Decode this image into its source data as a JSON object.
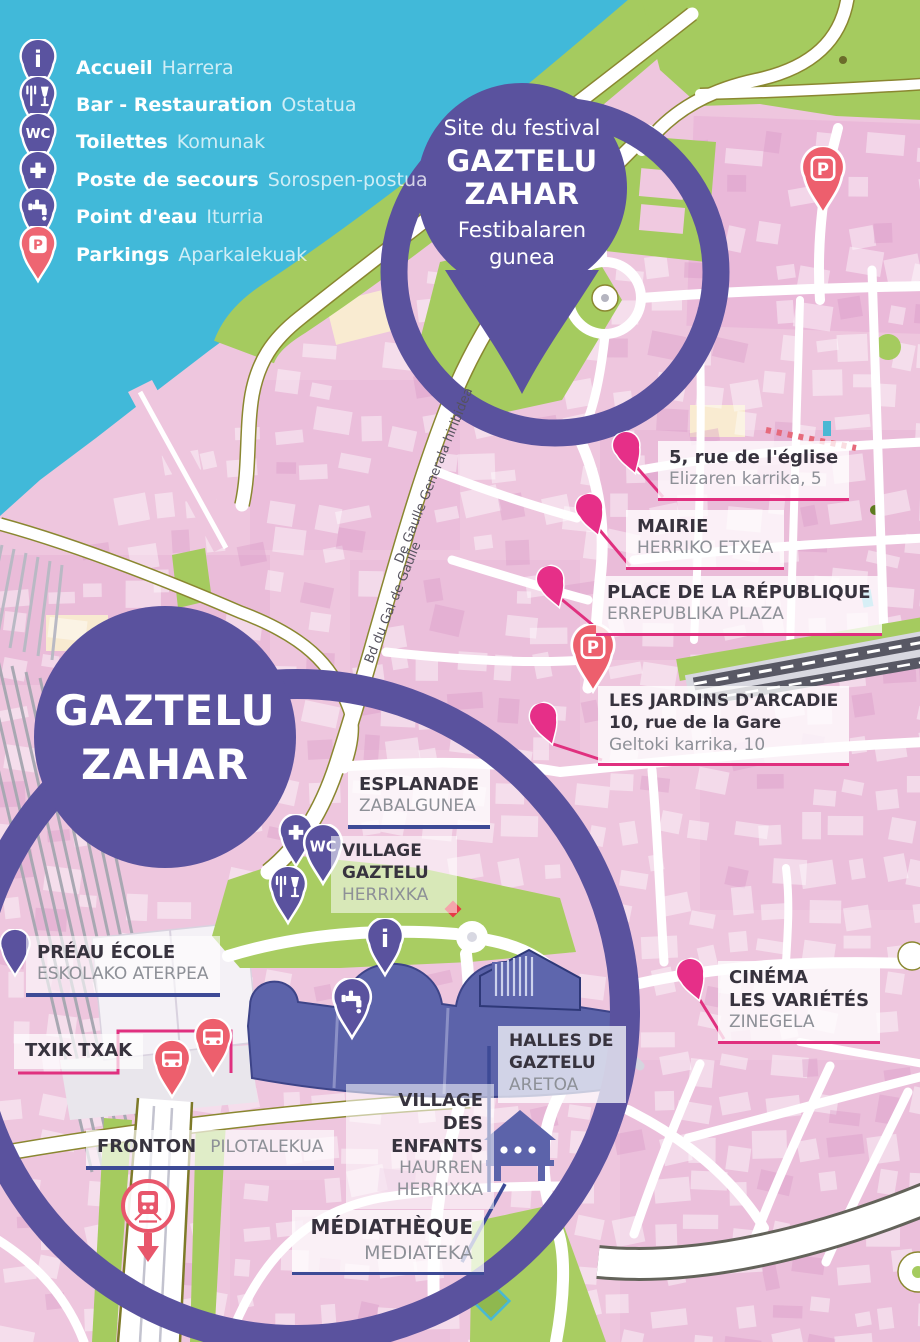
{
  "colors": {
    "water": "#41b9d9",
    "land": "#eec6de",
    "green": "#a5cb5f",
    "purple": "#5a529e",
    "building_purple": "#5c63aa",
    "poi_pink": "#e62f88",
    "coral": "#ed5f6d",
    "label_dark": "#37333e",
    "label_gray": "#8d9097",
    "leader_pink": "#e0307f",
    "connector_blue": "#3d4a96"
  },
  "glyphs": {
    "info": "i",
    "wc": "WC",
    "parking": "P"
  },
  "legend": {
    "accueil": {
      "fr": "Accueil",
      "eu": "Harrera"
    },
    "bar": {
      "fr": "Bar - Restauration",
      "eu": "Ostatua"
    },
    "toilettes": {
      "fr": "Toilettes",
      "eu": "Komunak"
    },
    "secours": {
      "fr": "Poste de secours",
      "eu": "Sorospen-postua"
    },
    "eau": {
      "fr": "Point d'eau",
      "eu": "Iturria"
    },
    "parkings": {
      "fr": "Parkings",
      "eu": "Aparkalekuak"
    }
  },
  "festival_pin": {
    "subtitle": "Site du festival",
    "title1": "GAZTELU",
    "title2": "ZAHAR",
    "eu1": "Festibalaren",
    "eu2": "gunea"
  },
  "site_circle": {
    "line1": "GAZTELU",
    "line2": "ZAHAR"
  },
  "poi": {
    "eglise": {
      "fr": "5, rue de l'église",
      "eu": "Elizaren karrika, 5"
    },
    "mairie": {
      "fr": "MAIRIE",
      "eu": "HERRIKO ETXEA"
    },
    "republique": {
      "fr": "PLACE DE LA RÉPUBLIQUE",
      "eu": "ERREPUBLIKA PLAZA"
    },
    "jardins": {
      "fr1": "LES JARDINS D'ARCADIE",
      "fr2": "10, rue de la Gare",
      "eu": "Geltoki karrika, 10"
    },
    "cinema": {
      "fr1": "CINÉMA",
      "fr2": "LES VARIÉTÉS",
      "eu": "ZINEGELA"
    }
  },
  "zones": {
    "esplanade": {
      "fr": "ESPLANADE",
      "eu": "ZABALGUNEA"
    },
    "village_gaztelu": {
      "fr": "VILLAGE GAZTELU",
      "eu": "HERRIXKA"
    },
    "preau": {
      "fr": "PRÉAU ÉCOLE",
      "eu": "ESKOLAKO ATERPEA"
    },
    "txik_txak": {
      "fr": "TXIK TXAK"
    },
    "halles": {
      "fr": "HALLES DE GAZTELU",
      "eu": "ARETOA"
    },
    "enfants": {
      "fr": "VILLAGE DES ENFANTS",
      "eu": "HAURREN HERRIXKA"
    },
    "fronton": {
      "fr": "FRONTON",
      "eu": "PILOTALEKUA"
    },
    "mediatheque": {
      "fr": "MÉDIATHÈQUE",
      "eu": "MEDIATEKA"
    }
  },
  "streets": {
    "gal_de_gaulle_fr": "Bd du Gal de Gaulle",
    "gal_de_gaulle_eu": "De Gaulle Generala hiribidea"
  }
}
